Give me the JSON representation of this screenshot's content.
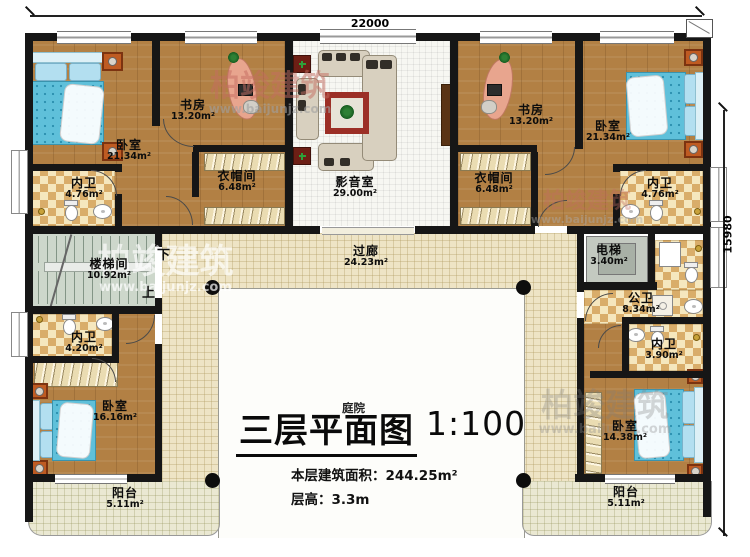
{
  "title": {
    "main": "三层平面图",
    "scale": "1:100",
    "courtyard": "庭院",
    "area_line": "本层建筑面积：244.25m²",
    "floor_height": "层高：3.3m"
  },
  "dimensions": {
    "top": "22000",
    "right": "15980"
  },
  "stairs": {
    "down": "下",
    "up": "上"
  },
  "watermark": {
    "brand": "柏竣建筑",
    "url": "www.baijunjz.com"
  },
  "rooms": {
    "bedroom_tl": {
      "name": "卧室",
      "area": "21.34m²"
    },
    "study_tl": {
      "name": "书房",
      "area": "13.20m²"
    },
    "bath_tl": {
      "name": "内卫",
      "area": "4.76m²"
    },
    "closet_tl": {
      "name": "衣帽间",
      "area": "6.48m²"
    },
    "media": {
      "name": "影音室",
      "area": "29.00m²"
    },
    "study_tr": {
      "name": "书房",
      "area": "13.20m²"
    },
    "bedroom_tr": {
      "name": "卧室",
      "area": "21.34m²"
    },
    "closet_tr": {
      "name": "衣帽间",
      "area": "6.48m²"
    },
    "bath_tr": {
      "name": "内卫",
      "area": "4.76m²"
    },
    "stairwell": {
      "name": "楼梯间",
      "area": "10.92m²"
    },
    "corridor": {
      "name": "过廊",
      "area": "24.23m²"
    },
    "elevator": {
      "name": "电梯",
      "area": "3.40m²"
    },
    "public_bath": {
      "name": "公卫",
      "area": "8.34m²"
    },
    "bath_br": {
      "name": "内卫",
      "area": "3.90m²"
    },
    "bath_bl": {
      "name": "内卫",
      "area": "4.20m²"
    },
    "bedroom_bl": {
      "name": "卧室",
      "area": "16.16m²"
    },
    "balcony_bl": {
      "name": "阳台",
      "area": "5.11m²"
    },
    "bedroom_br": {
      "name": "卧室",
      "area": "14.38m²"
    },
    "balcony_br": {
      "name": "阳台",
      "area": "5.11m²"
    }
  }
}
